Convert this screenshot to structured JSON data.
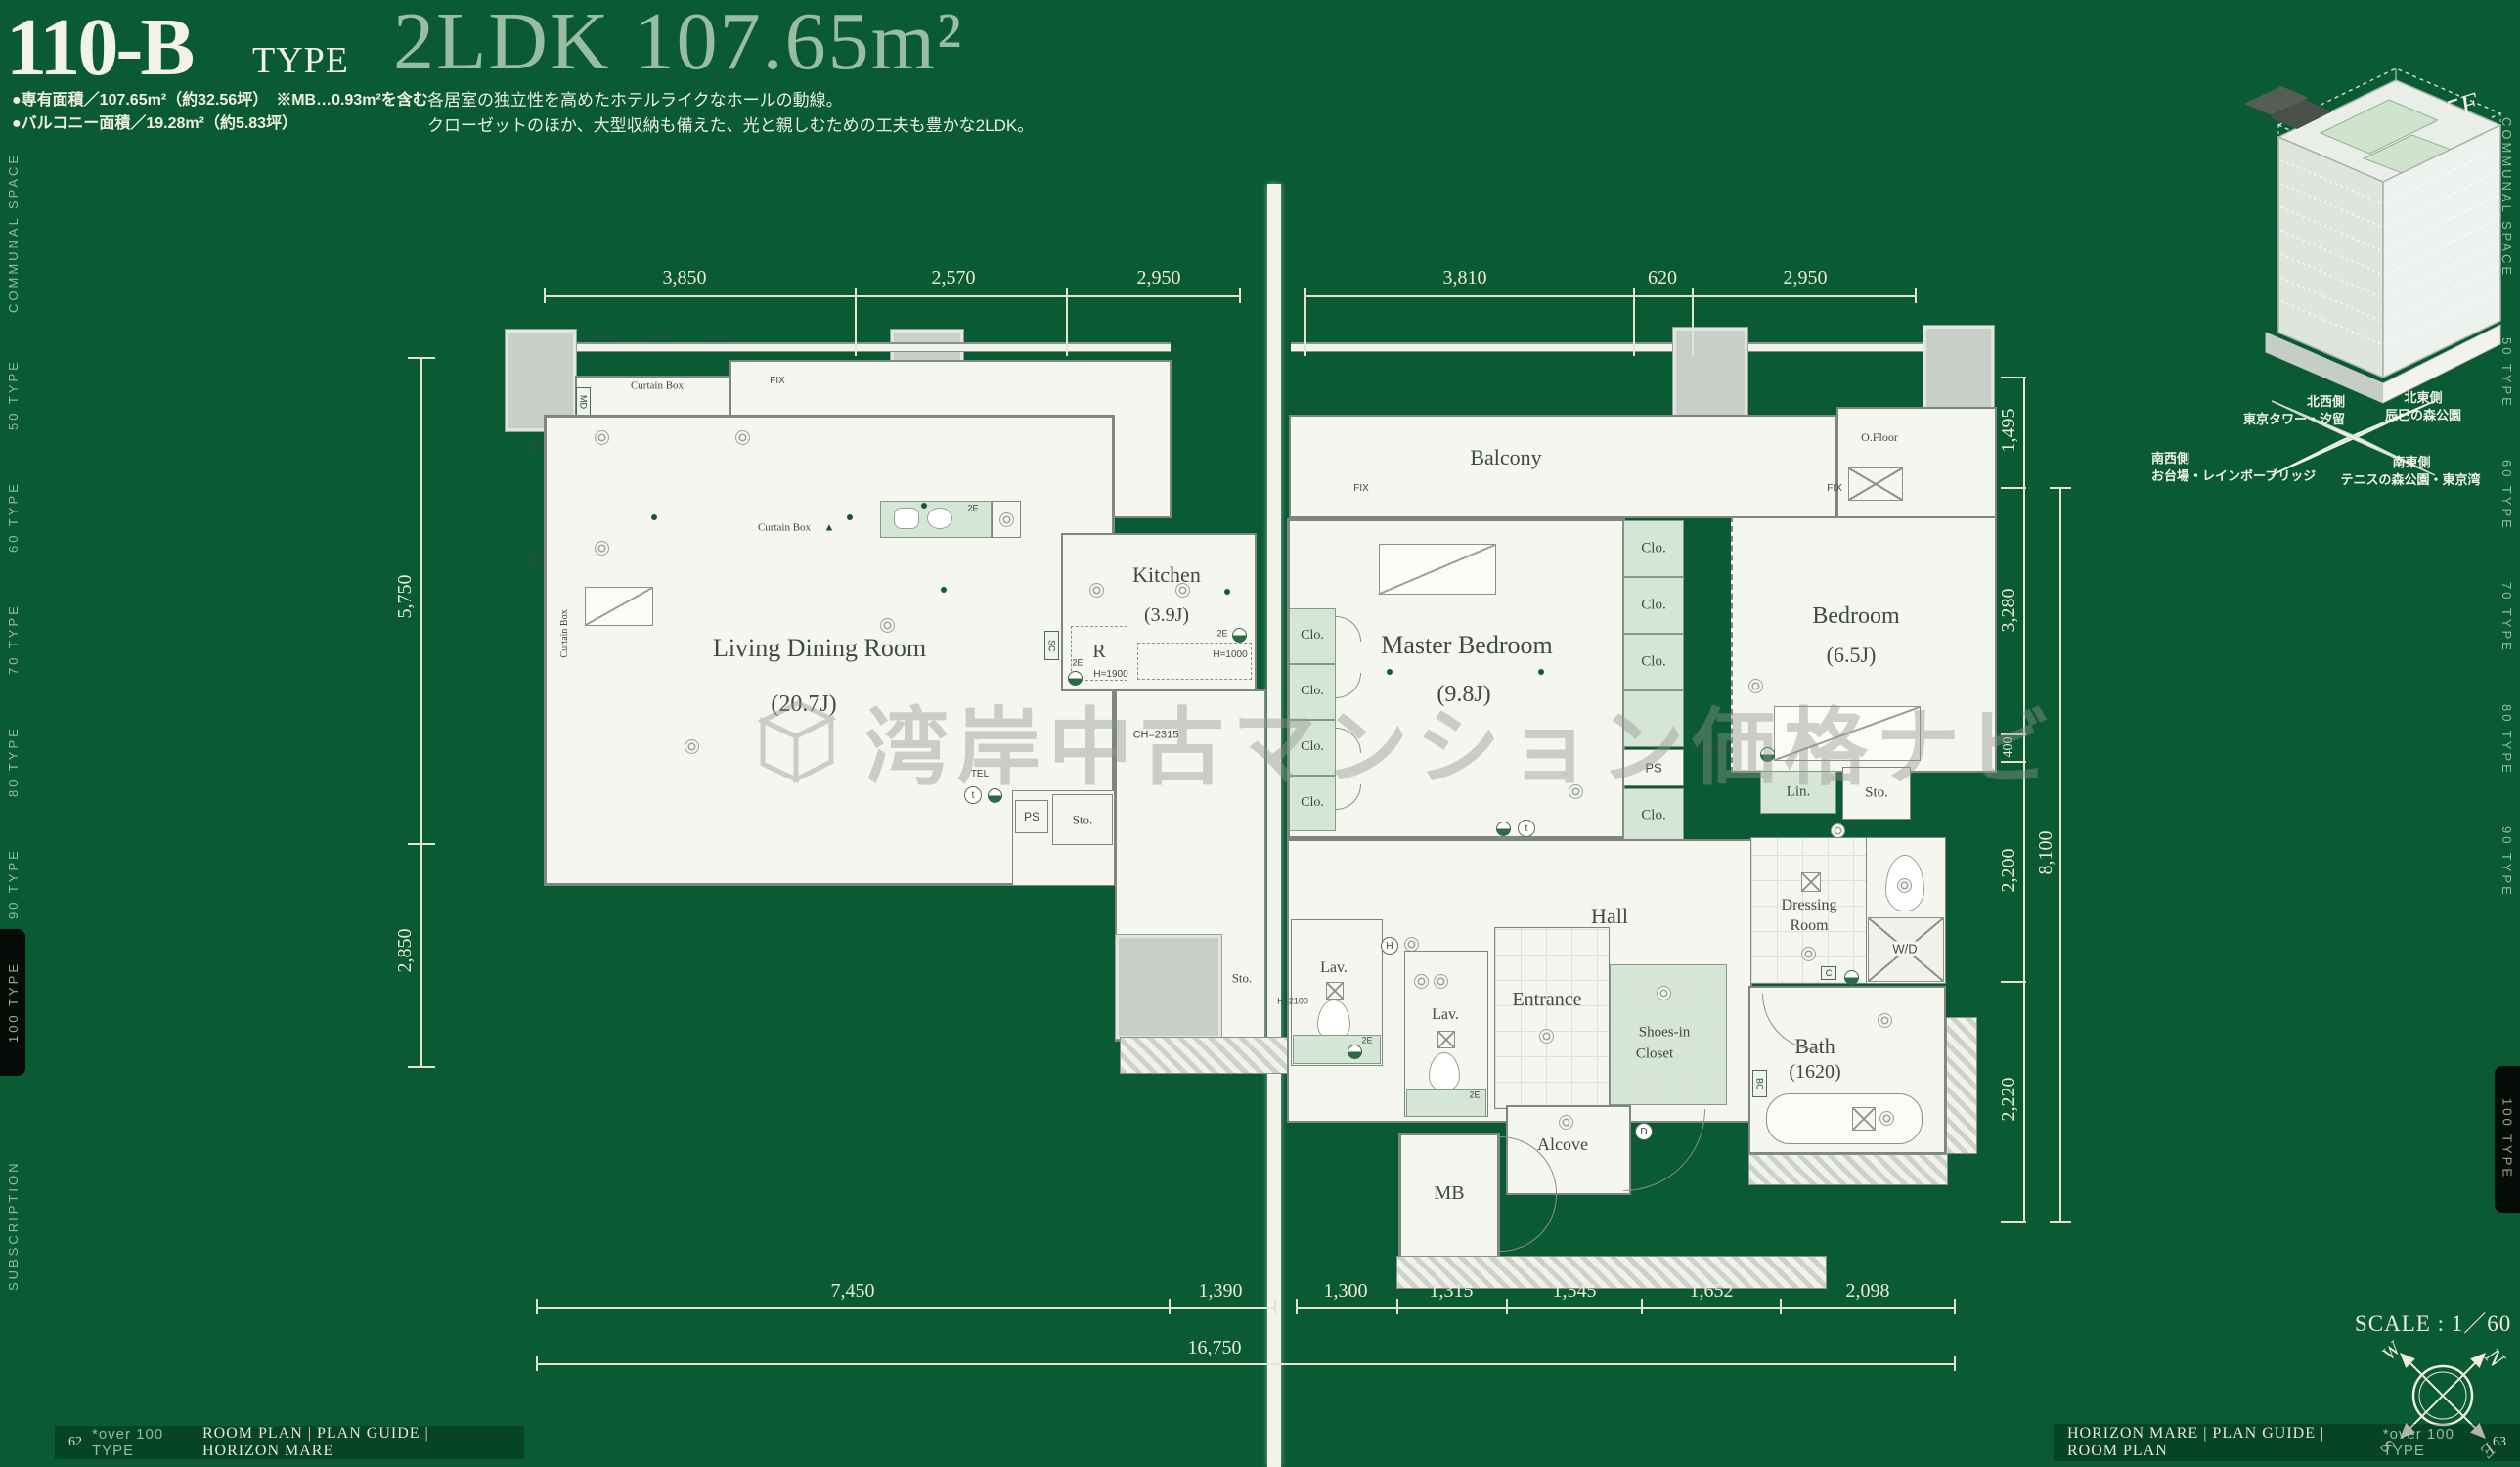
{
  "header": {
    "code": "110-B",
    "code_suffix": "TYPE",
    "spec": "2LDK 107.65m²",
    "area_line1": "●専有面積／107.65m²（約32.56坪）　※MB…0.93m²を含む",
    "area_line2": "●バルコニー面積／19.28m²（約5.83坪）",
    "desc_line1": "各居室の独立性を高めたホテルライクなホールの動線。",
    "desc_line2": "クローゼットのほか、大型収納も備えた、光と親しむための工夫も豊かな2LDK。"
  },
  "watermark": {
    "text": "湾岸中古マンション価格ナビ"
  },
  "rooms": {
    "living": "Living Dining Room",
    "living_size": "(20.7J)",
    "kitchen": "Kitchen",
    "kitchen_size": "(3.9J)",
    "master": "Master Bedroom",
    "master_size": "(9.8J)",
    "bedroom": "Bedroom",
    "bedroom_size": "(6.5J)",
    "balcony": "Balcony",
    "hall": "Hall",
    "entrance": "Entrance",
    "alcove": "Alcove",
    "mb": "MB",
    "dressing1": "Dressing",
    "dressing2": "Room",
    "wd": "W/D",
    "bath": "Bath",
    "bath_size": "(1620)",
    "shoes1": "Shoes-in",
    "shoes2": "Closet",
    "lav": "Lav.",
    "lin": "Lin.",
    "sto": "Sto.",
    "clo": "Clo.",
    "ps": "PS",
    "ofloor": "O.Floor"
  },
  "marks": {
    "fix": "FIX",
    "curtain_box": "Curtain Box",
    "counter": "Counter",
    "md": "MD",
    "sc": "SC",
    "r": "R",
    "l": "L",
    "tel": "TEL",
    "c": "C",
    "bc": "BC",
    "d": "D",
    "h": "H",
    "t": "t",
    "e2": "2E",
    "ch2315": "CH=2315",
    "ch2275": "CH=2275",
    "h1900": "H=1900",
    "h1000": "H=1000",
    "h2100": "H=2100",
    "tri": "▲",
    "arrow_l": "←",
    "arrow_r": "→"
  },
  "dims": {
    "t1": "3,850",
    "t2": "2,570",
    "t3": "2,950",
    "t4": "3,810",
    "t5": "620",
    "t6": "2,950",
    "l1": "5,750",
    "l2": "2,850",
    "r1": "1,495",
    "r2": "3,280",
    "r3": "400",
    "r4": "2,200",
    "r5": "2,220",
    "r_total": "8,100",
    "b1": "7,450",
    "b2": "1,390",
    "b3": "1,300",
    "b4": "1,315",
    "b5": "1,545",
    "b6": "1,652",
    "b7": "2,098",
    "b_total": "16,750"
  },
  "inset": {
    "floor": "25F",
    "nw_side": "北西側",
    "nw_place": "東京タワー・汐留",
    "ne_side": "北東側",
    "ne_place": "辰巳の森公園",
    "sw_side": "南西側",
    "sw_place": "お台場・レインボーブリッジ",
    "se_side": "南東側",
    "se_place": "テニスの森公園・東京湾"
  },
  "scale_label": "SCALE : 1／60",
  "compass": {
    "n": "N",
    "e": "E",
    "s": "S",
    "w": "W"
  },
  "edge_tabs": {
    "communal": "COMMUNAL SPACE",
    "t50": "50 TYPE",
    "t60": "60 TYPE",
    "t70": "70 TYPE",
    "t80": "80 TYPE",
    "t90": "90 TYPE",
    "active": "100 TYPE",
    "subscription": "SUBSCRIPTION"
  },
  "footer": {
    "left_no": "62",
    "left_type": "*over 100 TYPE",
    "left_rest": "ROOM PLAN | PLAN GUIDE | HORIZON MARE",
    "right_main": "HORIZON MARE | PLAN GUIDE | ROOM PLAN",
    "right_type": "*over 100 TYPE",
    "right_no": "63"
  }
}
